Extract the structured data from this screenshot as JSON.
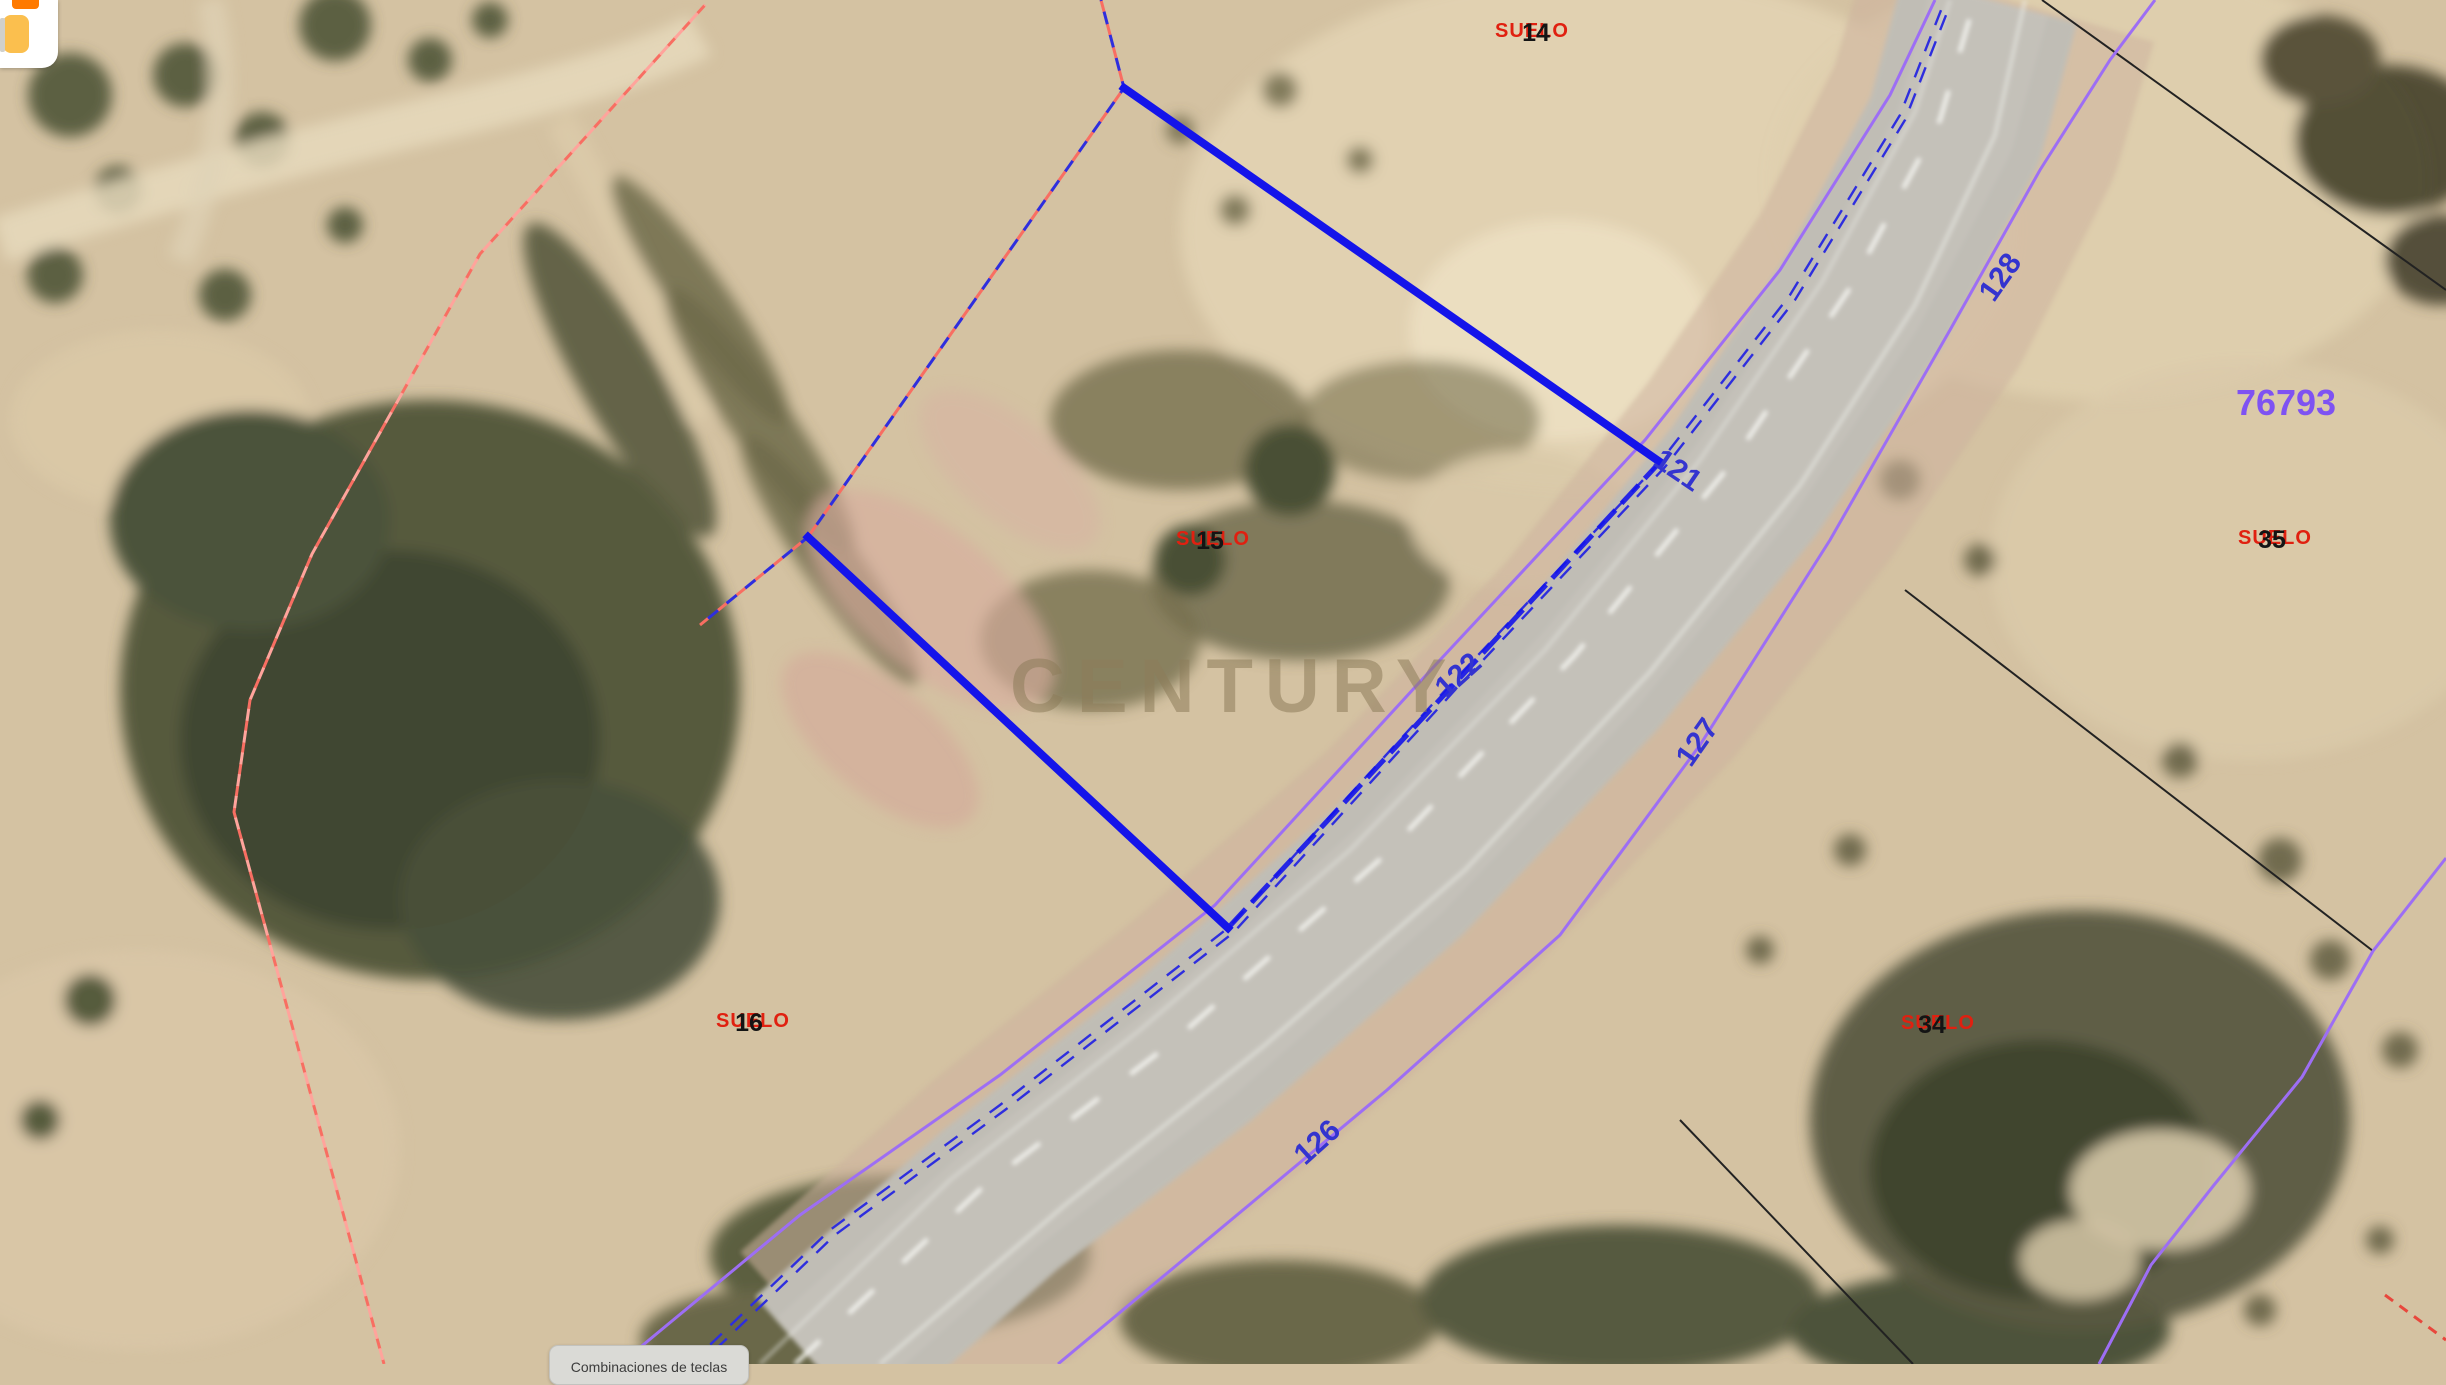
{
  "watermark": "CENTURY",
  "icons": {
    "brand_logo": "orange-and-amber-squares-logo"
  },
  "labels": {
    "suelo": [
      {
        "word": "SUELO",
        "num": "14"
      },
      {
        "word": "SUELO",
        "num": "15"
      },
      {
        "word": "SUELO",
        "num": "16"
      },
      {
        "word": "SUELO",
        "num": "34"
      },
      {
        "word": "SUELO",
        "num": "35"
      }
    ],
    "boundary_numbers": [
      "128",
      "121",
      "122",
      "127",
      "126"
    ],
    "big_parcel": "76793"
  },
  "tooltip": {
    "label": "Combinaciones de teclas"
  },
  "colors": {
    "selection_blue": "#1414ea",
    "boundary_lavender": "#9d6ef4",
    "boundary_number_blue": "#3434cf",
    "big_parcel_purple": "#7e52f2",
    "suelo_red": "#e02010",
    "suelo_num_black": "#141414",
    "dashed_pink": "#f86e62",
    "dashed_pink_light": "#ffa49c",
    "black_boundary": "#222222",
    "road_dashed_blue": "#2e2ede",
    "red_dashed": "#e8473c"
  }
}
